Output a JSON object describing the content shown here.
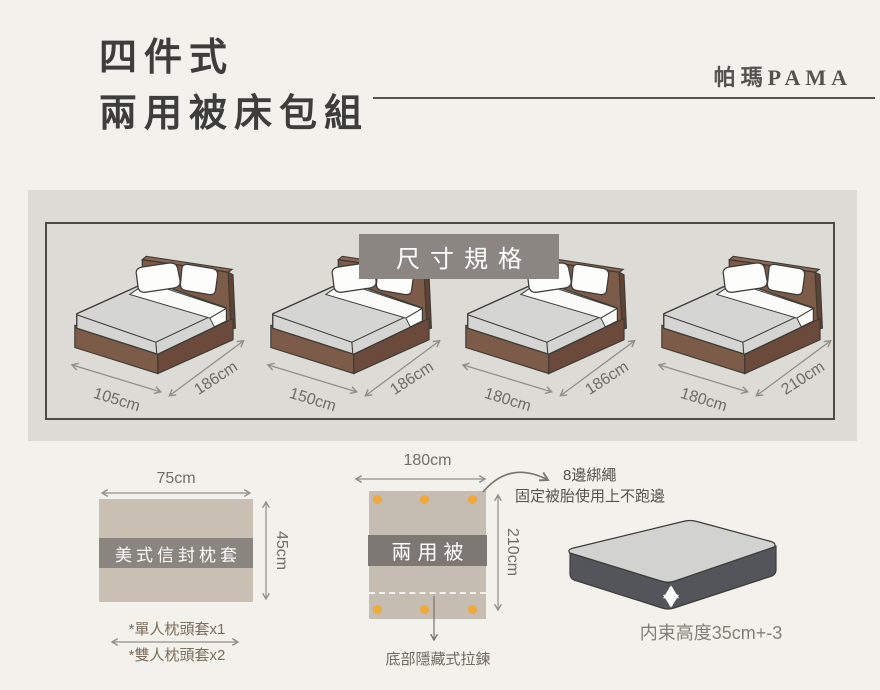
{
  "header": {
    "title_line1": "四件式",
    "title_line2": "兩用被床包組",
    "brand": "帕瑪PAMA"
  },
  "spec_panel": {
    "badge": "尺寸規格",
    "beds": [
      {
        "name": "single",
        "width": "105cm",
        "length": "186cm"
      },
      {
        "name": "double",
        "width": "150cm",
        "length": "186cm"
      },
      {
        "name": "queen",
        "width": "180cm",
        "length": "186cm"
      },
      {
        "name": "king",
        "width": "180cm",
        "length": "210cm"
      }
    ]
  },
  "pillow": {
    "width_label": "75cm",
    "height_label": "45cm",
    "name": "美式信封枕套",
    "note1": "*單人枕頭套x1",
    "note2": "*雙人枕頭套x2"
  },
  "quilt": {
    "width_label": "180cm",
    "height_label": "210cm",
    "name": "兩用被",
    "tie_note_title": "8邊綁繩",
    "tie_note_desc": "固定被胎使用上不跑邊",
    "zipper_note": "底部隱藏式拉鍊"
  },
  "mattress": {
    "height_note": "内束高度35cm+-3"
  },
  "colors": {
    "page_bg": "#f2f1ec",
    "panel_bg": "#dcdbd6",
    "badge_bg": "#8b8681",
    "bed_frame_brown": "#7d5b49",
    "mattress_gray": "#d5d6d3",
    "fabric_beige": "#c9bfb3",
    "label_band_gray": "#7d7873",
    "tie_dot_orange": "#f1a93c",
    "text_dark": "#3d3d3b"
  }
}
